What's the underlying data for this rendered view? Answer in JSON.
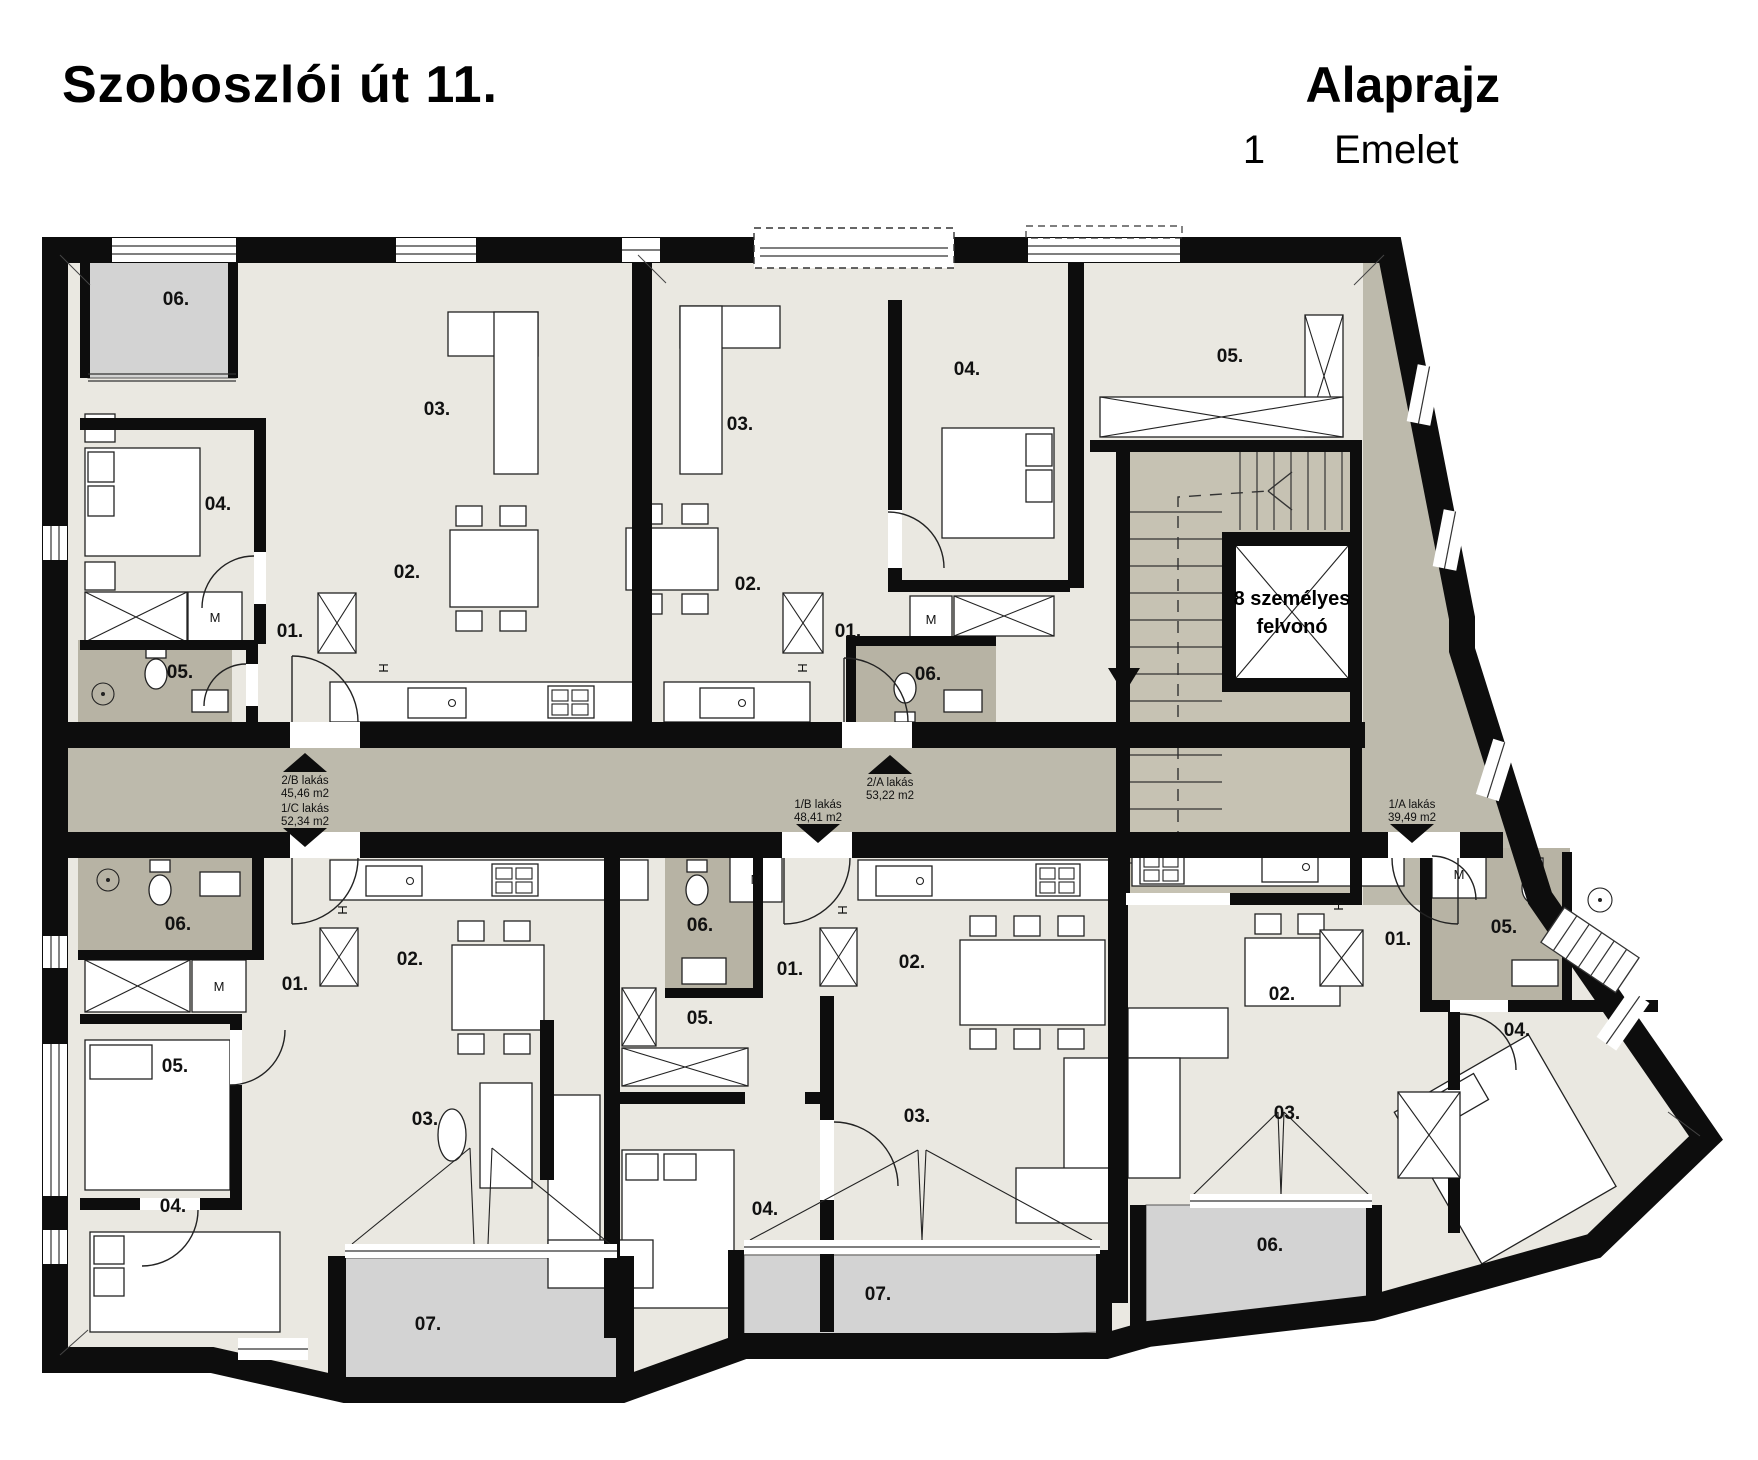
{
  "header": {
    "title": "Szoboszlói út 11.",
    "plan_type": "Alaprajz",
    "floor_number": "1",
    "floor_word": "Emelet"
  },
  "elevator": {
    "line1": "8 személyes",
    "line2": "felvonó"
  },
  "glyphs": {
    "washing_machine": "M",
    "fridge": "H"
  },
  "apartments": [
    {
      "name": "2/B lakás",
      "area": "45,46 m2",
      "arrow": "up"
    },
    {
      "name": "1/C lakás",
      "area": "52,34 m2",
      "arrow": "down"
    },
    {
      "name": "2/A lakás",
      "area": "53,22 m2",
      "arrow": "up"
    },
    {
      "name": "1/B lakás",
      "area": "48,41 m2",
      "arrow": "down"
    },
    {
      "name": "1/A lakás",
      "area": "39,49 m2",
      "arrow": "down"
    }
  ],
  "rooms": [
    "06.",
    "03.",
    "04.",
    "02.",
    "01.",
    "05.",
    "03.",
    "02.",
    "01.",
    "04.",
    "06.",
    "05.",
    "06.",
    "01.",
    "02.",
    "05.",
    "03.",
    "04.",
    "07.",
    "06.",
    "01.",
    "02.",
    "05.",
    "04.",
    "03.",
    "07.",
    "02.",
    "01.",
    "05.",
    "04.",
    "03.",
    "06."
  ],
  "colors": {
    "wall": "#0d0d0d",
    "room_floor": "#eae8e1",
    "corridor": "#bdbaac",
    "balcony": "#d3d3d3",
    "bathroom": "#b7b3a4",
    "stairs": "#c6c2b3"
  }
}
